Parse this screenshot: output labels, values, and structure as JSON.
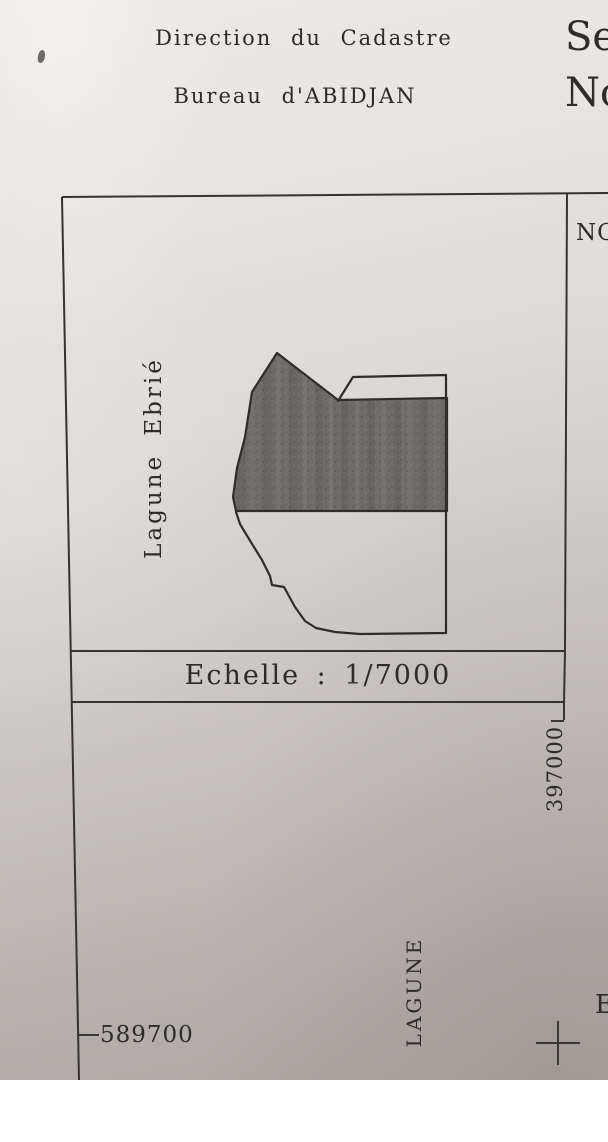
{
  "header": {
    "line1": "Direction du Cadastre",
    "line2": "Bureau d'ABIDJAN"
  },
  "top_right_partial": {
    "line1": "Se",
    "line2": "No"
  },
  "right_panel": {
    "label": "NO"
  },
  "map": {
    "water_label": "Lagune Ebrié",
    "scale_label": "Echelle : 1/7000"
  },
  "coordinates": {
    "y_label": "397000",
    "x_label": "589700"
  },
  "bottom": {
    "lagune_label": "LAGUNE",
    "edge_partial_letter": "E"
  },
  "colors": {
    "paper_top": "#ece9e4",
    "paper_bottom": "#aca79f",
    "ink": "#35332e",
    "parcel_fill": "#6f6c65"
  }
}
